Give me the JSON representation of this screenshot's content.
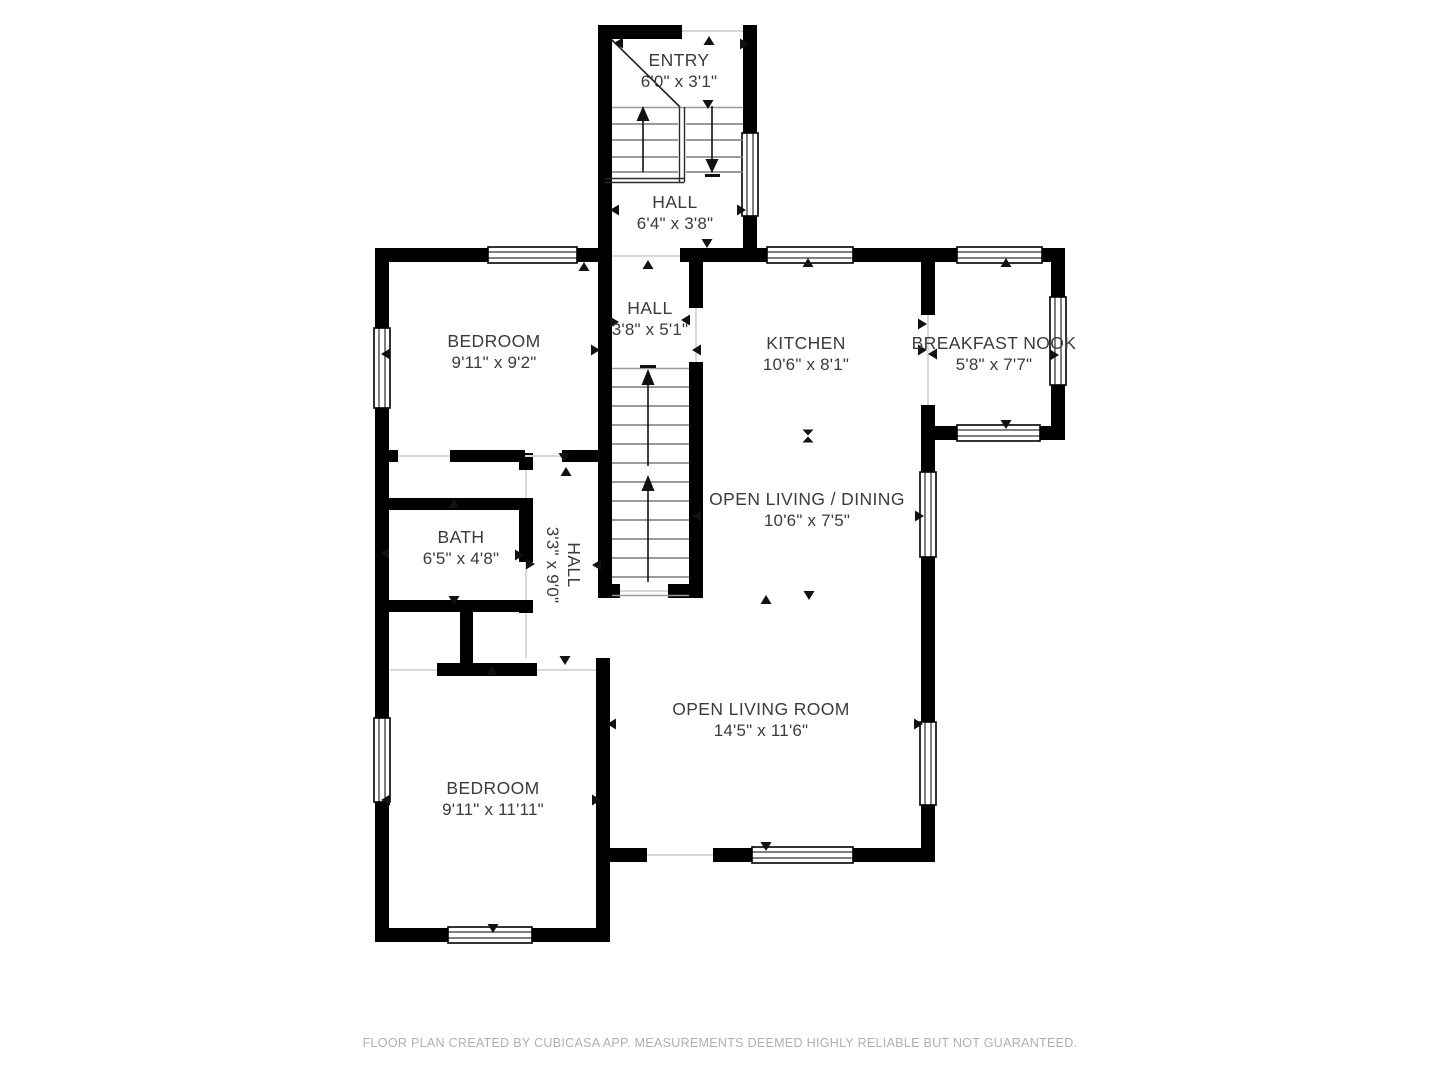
{
  "colors": {
    "wall": "#000000",
    "room_text": "#3b3b3b",
    "footer_text": "#b0b0b0",
    "tread": "#787878",
    "opening_line": "#d8d8d8",
    "bg": "#ffffff"
  },
  "rooms": [
    {
      "id": "entry",
      "name": "ENTRY",
      "dims": "6'0\" x 3'1\""
    },
    {
      "id": "hall-upper",
      "name": "HALL",
      "dims": "6'4\" x 3'8\""
    },
    {
      "id": "hall-mid",
      "name": "HALL",
      "dims": "3'8\" x 5'1\""
    },
    {
      "id": "bedroom-top",
      "name": "BEDROOM",
      "dims": "9'11\" x 9'2\""
    },
    {
      "id": "kitchen",
      "name": "KITCHEN",
      "dims": "10'6\" x 8'1\""
    },
    {
      "id": "breakfast-nook",
      "name": "BREAKFAST NOOK",
      "dims": "5'8\" x 7'7\""
    },
    {
      "id": "open-living-dining",
      "name": "OPEN LIVING / DINING",
      "dims": "10'6\" x 7'5\""
    },
    {
      "id": "bath",
      "name": "BATH",
      "dims": "6'5\" x 4'8\"",
      "label_rotation_deg": 0
    },
    {
      "id": "hall-lower",
      "name": "HALL",
      "dims": "3'3\" x 9'0\"",
      "label_rotation_deg": 90
    },
    {
      "id": "bedroom-bottom",
      "name": "BEDROOM",
      "dims": "9'11\" x 11'11\""
    },
    {
      "id": "open-living-room",
      "name": "OPEN LIVING ROOM",
      "dims": "14'5\" x 11'6\""
    }
  ],
  "footer": {
    "text": "FLOOR PLAN CREATED BY CUBICASA APP. MEASUREMENTS DEEMED HIGHLY RELIABLE BUT NOT GUARANTEED."
  }
}
